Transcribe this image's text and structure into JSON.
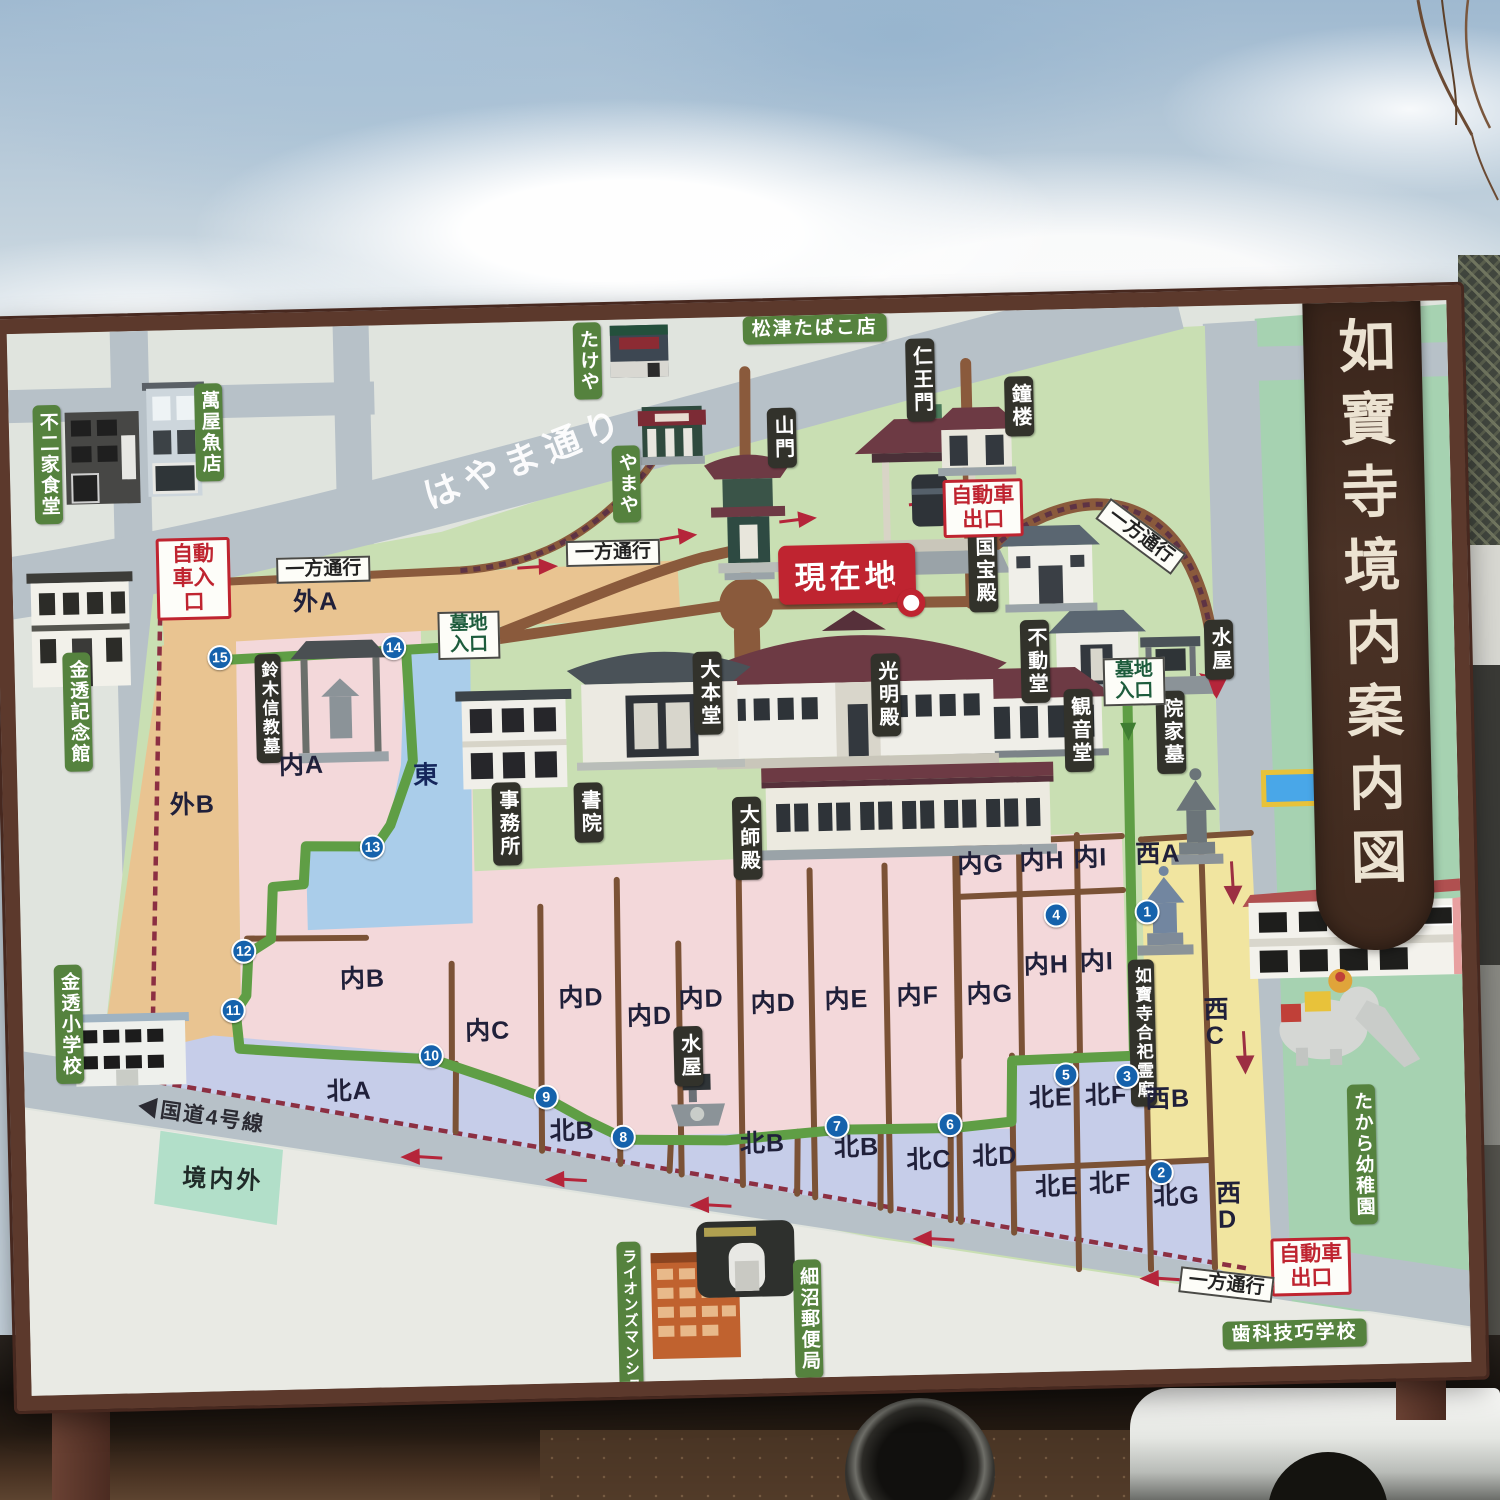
{
  "map_title": "如寶寺境内案内図",
  "current_location": "現在地",
  "traffic": {
    "car_entrance": "自動車入口",
    "car_exit": "自動車出口",
    "one_way": "一方通行",
    "cemetery_entrance": "墓地入口"
  },
  "temple_buildings": {
    "sanmon": "山門",
    "shoro": "鐘楼",
    "niomon": "仁王門",
    "kokuhoden": "国宝殿",
    "fudodo": "不動堂",
    "mizuya": "水屋",
    "kannondo": "観音堂",
    "daihondo": "大本堂",
    "komyoden": "光明殿",
    "jimusho": "事務所",
    "shoin": "書院",
    "daishiden": "大師殿",
    "inkebo": "院家墓",
    "suzuki_shinkyo_grave": "鈴木信教墓",
    "goshi_reibyo": "如寶寺合祀霊廟"
  },
  "neighborhood": {
    "matsuzu_tobacco": "松津たばこ店",
    "takeya": "たけや",
    "yamaya": "やまや",
    "fujiya_shokudo": "不二家食堂",
    "yorozuya_uoten": "萬屋魚店",
    "kinto_kinenkan": "金透記念館",
    "kinto_shogakko": "金透小学校",
    "lions_mansion": "ライオンズマンション",
    "hosonuma_post_office": "細沼郵便局",
    "shika_giko_gakko": "歯科技巧学校",
    "takara_kindergarten": "たから幼稚園"
  },
  "roads": {
    "hayama_street": "はやま通り",
    "route4": "◀国道4号線",
    "keidai_gai": "境内外"
  },
  "sections": {
    "soto_a": "外A",
    "soto_b": "外B",
    "uchi_a": "内A",
    "uchi_b": "内B",
    "uchi_c": "内C",
    "uchi_d": "内D",
    "uchi_e": "内E",
    "uchi_f": "内F",
    "uchi_g": "内G",
    "uchi_h": "内H",
    "uchi_i": "内I",
    "kita_a": "北A",
    "kita_b": "北B",
    "kita_c": "北C",
    "kita_d": "北D",
    "kita_e": "北E",
    "kita_f": "北F",
    "kita_g": "北G",
    "nishi_a": "西A",
    "nishi_b": "西B",
    "nishi_c": "西C",
    "nishi_d": "西D",
    "higashi": "東"
  },
  "route_numbers": [
    "1",
    "2",
    "3",
    "4",
    "5",
    "6",
    "7",
    "8",
    "9",
    "10",
    "11",
    "12",
    "13",
    "14",
    "15"
  ]
}
